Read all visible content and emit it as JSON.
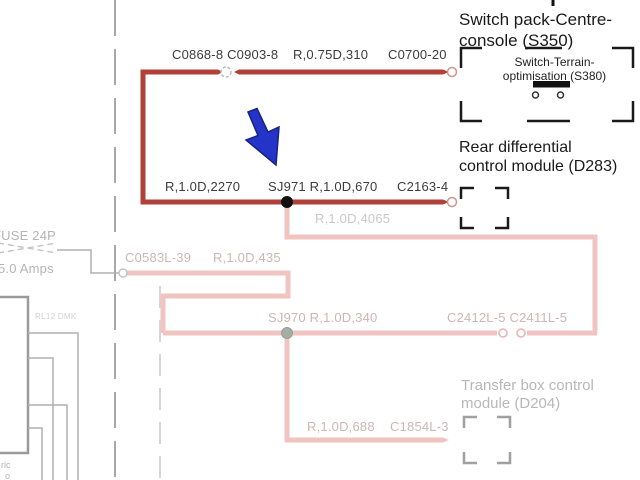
{
  "diagram_type": "automotive wiring diagram",
  "colors": {
    "active_wire_red": "#b04138",
    "faded_wire_pink": "#f1c4c1",
    "faded_label_pink": "#ccb7b4",
    "faded_label_gray": "#c9c9c9",
    "background_gray": "#b0b0b0",
    "annotation_arrow_blue": "#2433c8",
    "splice_black": "#111111"
  },
  "modules": {
    "switch_pack": {
      "title_line1": "Switch pack-Centre-",
      "title_line2": "console (S350)",
      "inner_line1": "Switch-Terrain-",
      "inner_line2": "optimisation (S380)"
    },
    "rear_diff": {
      "title_line1": "Rear differential",
      "title_line2": "control module (D283)"
    },
    "transfer_box": {
      "title_line1": "Transfer box control",
      "title_line2": "module (D204)"
    }
  },
  "wire_labels": {
    "top_row": {
      "connectors_left": "C0868-8 C0903-8",
      "wire_spec": "R,0.75D,310",
      "connector_right": "C0700-20"
    },
    "mid_row": {
      "wire_spec_left": "R,1.0D,2270",
      "splice_and_spec": "SJ971 R,1.0D,670",
      "connector_right": "C2163-4"
    },
    "branch_down": "R,1.0D,4065",
    "fuse_branch": {
      "connector": "C0583L-39",
      "wire_spec": "R,1.0D,435"
    },
    "lower_row": {
      "splice_and_spec": "SJ970 R,1.0D,340",
      "connectors": "C2412L-5 C2411L-5"
    },
    "bottom_row": {
      "wire_spec": "R,1.0D,688",
      "connector": "C1854L-3"
    }
  },
  "side_labels": {
    "fuse_name": "FUSE 24P",
    "fuse_rating": "5.0 Amps",
    "relay": "RL12 DMK",
    "corner_fragment_1": "ric",
    "corner_fragment_2": "o"
  }
}
